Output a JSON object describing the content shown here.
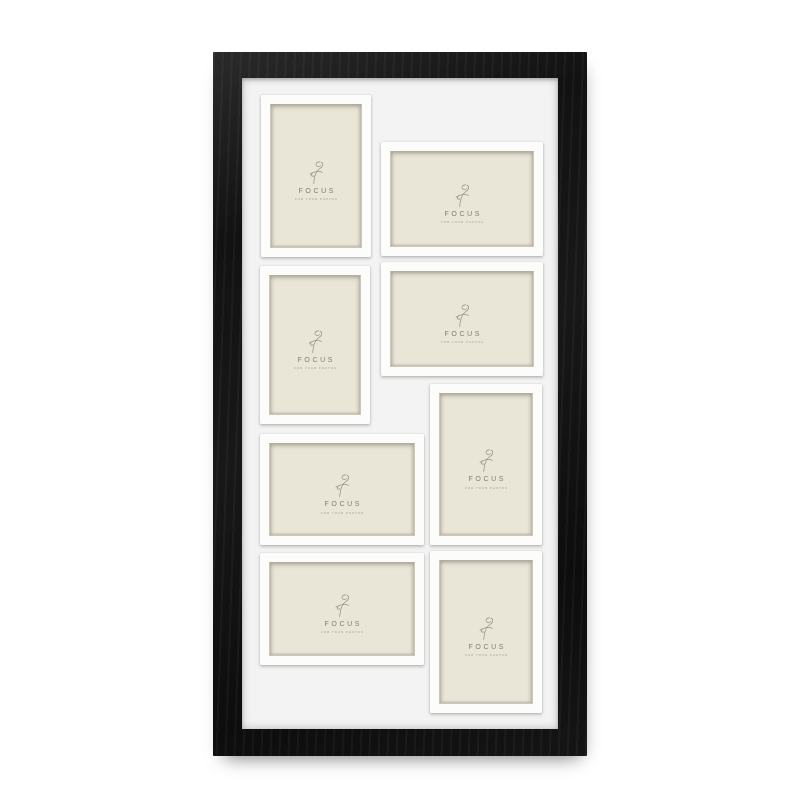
{
  "product": {
    "type": "collage picture frame",
    "openings_count": 8
  },
  "insert": {
    "brand": "FOCUS",
    "tagline": "FOR YOUR PHOTOS",
    "logo_icon": "script-f-icon"
  },
  "openings": [
    {
      "id": 1,
      "orientation": "portrait"
    },
    {
      "id": 2,
      "orientation": "landscape"
    },
    {
      "id": 3,
      "orientation": "portrait"
    },
    {
      "id": 4,
      "orientation": "landscape"
    },
    {
      "id": 5,
      "orientation": "portrait"
    },
    {
      "id": 6,
      "orientation": "landscape"
    },
    {
      "id": 7,
      "orientation": "landscape"
    },
    {
      "id": 8,
      "orientation": "portrait"
    }
  ],
  "colors": {
    "frame_black": "#151515",
    "mat_white": "#f3f3f4",
    "slot_white": "#fcfcfb",
    "insert_cream": "#e9e5d7",
    "logo_gray_brown": "#857d6c",
    "background": "#ffffff"
  }
}
